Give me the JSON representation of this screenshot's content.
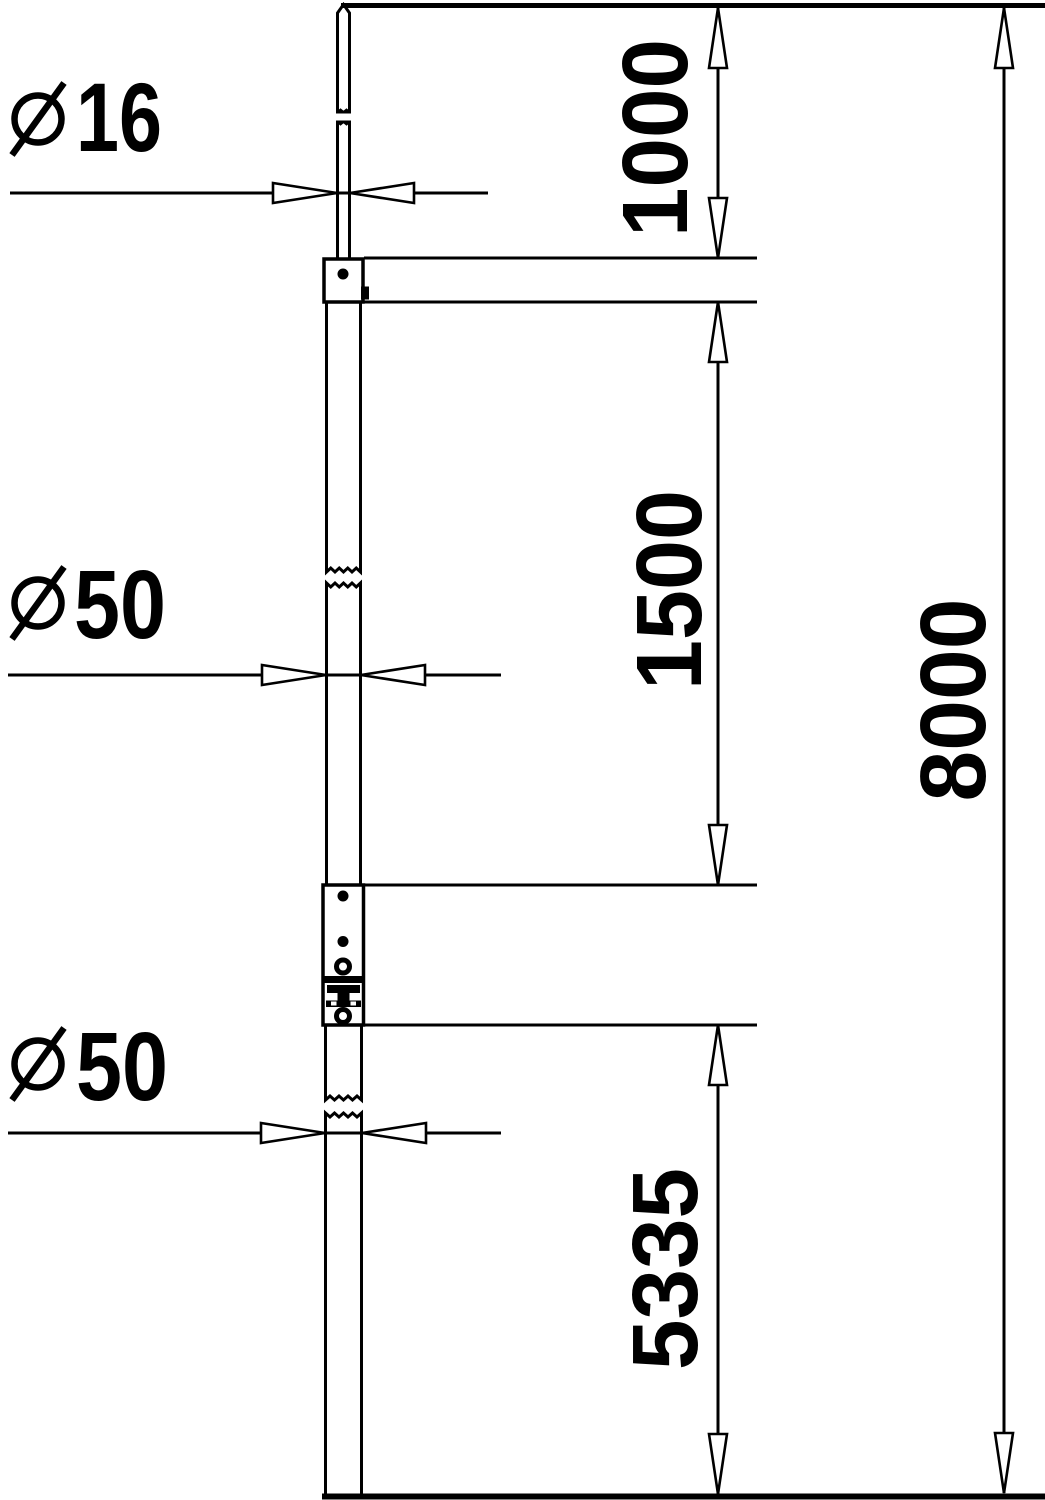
{
  "drawing": {
    "diameter_symbol": "⌀",
    "labels": {
      "rod_diameter": "16",
      "upper_tube_diameter": "50",
      "lower_tube_diameter": "50"
    },
    "dims": {
      "rod_length": "1000",
      "upper_tube_length": "1500",
      "lower_section_length": "5335",
      "total_height": "8000"
    }
  }
}
